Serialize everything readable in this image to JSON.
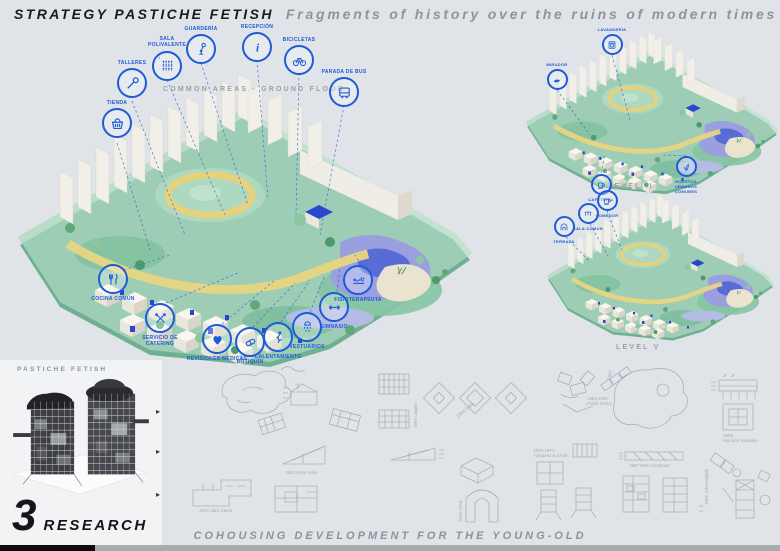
{
  "header": {
    "title": "STRATEGY  PASTICHE FETISH",
    "subtitle": "Fragments of history over the ruins of modern times"
  },
  "ground_floor": {
    "heading": "COMMON AREAS - GROUND FLOOR",
    "callouts_top": [
      {
        "label": "TIENDA",
        "icon": "basket-icon"
      },
      {
        "label": "TALLERES",
        "icon": "wrench-icon"
      },
      {
        "label": "SALA POLIVALENTE",
        "icon": "audience-icon"
      },
      {
        "label": "GUARDERÍA",
        "icon": "child-balloon-icon"
      },
      {
        "label": "RECEPCIÓN",
        "icon": "info-icon"
      },
      {
        "label": "BICICLETAS",
        "icon": "bicycle-icon"
      },
      {
        "label": "PARADA DE BUS",
        "icon": "bus-icon"
      }
    ],
    "callouts_bottom": [
      {
        "label": "COCINA COMÚN",
        "icon": "cutlery-icon"
      },
      {
        "label": "SERVICIO DE CATERING",
        "icon": "crossed-utensils-icon"
      },
      {
        "label": "REVISIONES MÉDICAS",
        "icon": "heart-icon"
      },
      {
        "label": "BOTIQUÍN",
        "icon": "pill-icon"
      },
      {
        "label": "CALENTAMIENTO",
        "icon": "stretching-icon"
      },
      {
        "label": "VESTUARIOS",
        "icon": "shower-icon"
      },
      {
        "label": "GIMNASIO",
        "icon": "double-arrow-icon"
      },
      {
        "label": "FISIOTERAPEUTA",
        "icon": "massage-icon"
      }
    ]
  },
  "levels": {
    "level2": {
      "label": "LEVEL II",
      "callouts": [
        {
          "label": "LAVANDERÍA",
          "icon": "laundry-icon"
        },
        {
          "label": "MIRADOR",
          "icon": "bird-icon"
        },
        {
          "label": "CAFETERÍA",
          "icon": "cup-icon"
        },
        {
          "label": "HUERTOS URBANOS COMUNES",
          "icon": "plant-icon"
        }
      ]
    },
    "level5": {
      "label": "LEVEL V",
      "callouts": [
        {
          "label": "COMEDOR",
          "icon": "cup-icon"
        },
        {
          "label": "SALA COMÚN",
          "icon": "people-icon"
        },
        {
          "label": "TERRAZA",
          "icon": "arch-icon"
        }
      ]
    }
  },
  "research": {
    "tag": "PASTICHE FETISH",
    "number": "3",
    "label": "RESEARCH"
  },
  "footer": {
    "caption": "COHOUSING DEVELOPMENT FOR THE YOUNG-OLD"
  },
  "references": {
    "aalto": "1953 Alvar Aalto",
    "utzon": "1972 Jørn Utzon",
    "ungers": "1966 Ungers",
    "gehry1": "1984-1987",
    "gehry2": "Frank Gehry",
    "tusq1": "1970-1972",
    "tusq2": "Tusquets & Clotet",
    "kiku1": "1958",
    "kiku2": "Kiyonori Kikutake",
    "kool": "1987 Rem Koolhaas",
    "hejduk": "1985 John Hejduk",
    "arch_years": "1925-1926",
    "diam_years": "1964-1966",
    "blob_year": "1987"
  },
  "colors": {
    "accent_blue": "#1d5bd8",
    "deep_blue": "#2946cc",
    "ground_green": "#9dceb5",
    "path_yellow": "#e8d583",
    "pond_lavender": "#9aa0df",
    "background": "#e0e3e7",
    "text_gray": "#8d939b",
    "ink": "#1a1b1e"
  }
}
